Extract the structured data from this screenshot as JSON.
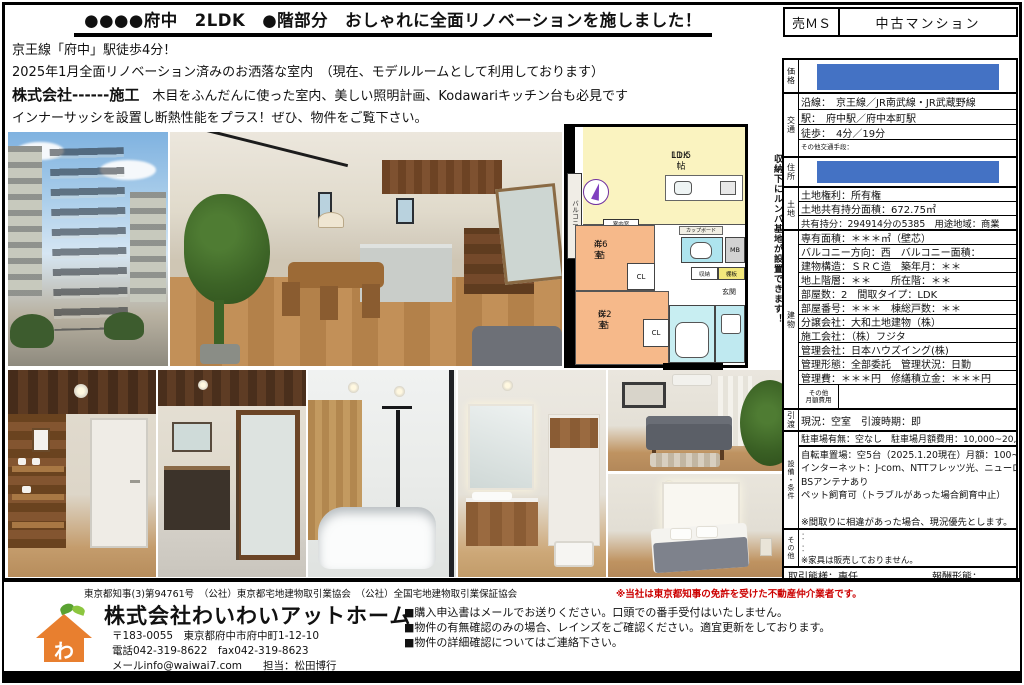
{
  "header": {
    "title": "●●●●府中　2LDK　●階部分　おしゃれに全面リノベーションを施しました！",
    "sale_code": "売ＭＳ",
    "property_type": "中古マンション"
  },
  "description": {
    "line1": "京王線「府中」駅徒歩4分！",
    "line2": "2025年1月全面リノベーション済みのお洒落な室内　（現在、モデルルームとして利用しております）",
    "line3_bold": "株式会社------施工",
    "line3_rest": "　木目をふんだんに使った室内、美しい照明計画、Kodawariキッチン台も必見です",
    "line4": "インナーサッシを設置し断熱性能をプラス！ぜひ、物件をご覧下さい。"
  },
  "floorplan": {
    "balcony": "バルコニー",
    "ldk_name": "LDK",
    "ldk_size": "11.5帖",
    "room1_name": "洋室",
    "room1_size": "4.6帖",
    "room2_name": "洋室",
    "room2_size": "6.2帖",
    "closet": "CL",
    "closet2": "CL",
    "meter_box": "MB",
    "storage": "収納",
    "shelf": "棚板",
    "entrance": "玄関",
    "cupboard": "カップボード",
    "interior_window": "室内窓",
    "roomba_note": "収納下にルンバ基地が設置できます！"
  },
  "table": {
    "price_label": "価格",
    "transport_label": "交通",
    "transport_rows": [
      "沿線：　京王線／JR南武線・JR武蔵野線",
      "駅：　府中駅／府中本町駅",
      "徒歩：　4分／19分"
    ],
    "transport_other": "その他交通手段：",
    "address_label": "住所",
    "land_label": "土地",
    "land_rows": [
      "土地権利：所有権",
      "土地共有持分面積：672.75㎡",
      "共有持分：294914分の5385　用途地域：商業"
    ],
    "building_label": "建物",
    "building_rows": [
      "専有面積：＊＊＊㎡（壁芯）",
      "バルコニー方向：西　バルコニー面積：",
      "建物構造：ＳＲＣ造　築年月：＊＊",
      "地上階層：＊＊　　所在階：＊＊",
      "部屋数：2　間取タイプ：LDK",
      "部屋番号：＊＊＊　棟総戸数：＊＊",
      "分譲会社：大和土地建物（株）",
      "施工会社：（株）フジタ",
      "管理会社：日本ハウズイング(株)",
      "管理形態：全部委託　管理状況：日勤",
      "管理費：＊＊＊円　修繕積立金：＊＊＊円"
    ],
    "monthly_other_label": "その他\n月額費用",
    "monthly_other_value": "",
    "handover_label": "引渡",
    "handover_row": "現況：空室　引渡時期：即",
    "equipment_label": "設備・条件",
    "parking_row": "駐車場有無：空なし　駐車場月額費用：10,000~20,000円",
    "equipment_rows": [
      "自転車置場：空5台（2025.1.20現在）月額：100~300円",
      "インターネット：J-com、NTTフレッツ光、ニューロ光",
      "BSアンテナあり",
      "ペット飼育可（トラブルがあった場合飼育中止）",
      "",
      "※間取りに相違があった場合、現況優先とします。"
    ],
    "other_label": "その他",
    "other_rows": [
      "：",
      "：",
      "※家具は販売しておりません。"
    ],
    "deal_type": "取引態様：専任",
    "fee_type": "報酬形態："
  },
  "footer": {
    "license_line": "東京都知事(3)第94761号　（公社）東京都宅地建物取引業協会　（公社）全国宅地建物取引業保証協会",
    "license_note": "※当社は東京都知事の免許を受けた不動産仲介業者です。",
    "logo_char": "わ",
    "company_name": "株式会社わいわいアットホーム",
    "company_address": "〒183-0055　東京都府中市府中町1-12-10",
    "company_phone": "電話042-319-8622　fax042-319-8623",
    "company_mail": "メールinfo@waiwai7.com　　担当：松田博行",
    "notes": [
      "■購入申込書はメールでお送りください。口頭での番手受付はいたしません。",
      "■物件の有無確認のみの場合、レインズをご確認ください。適宜更新をしております。",
      "■物件の詳細確認についてはご連絡下さい。"
    ]
  },
  "colors": {
    "redaction_blue": "#4472c4",
    "note_red": "#cc0000",
    "plan_ldk_yellow": "#faf3c0",
    "plan_room_orange": "#f6b98a",
    "plan_wet_cyan": "#aee4ee",
    "logo_orange": "#e87f2f"
  }
}
